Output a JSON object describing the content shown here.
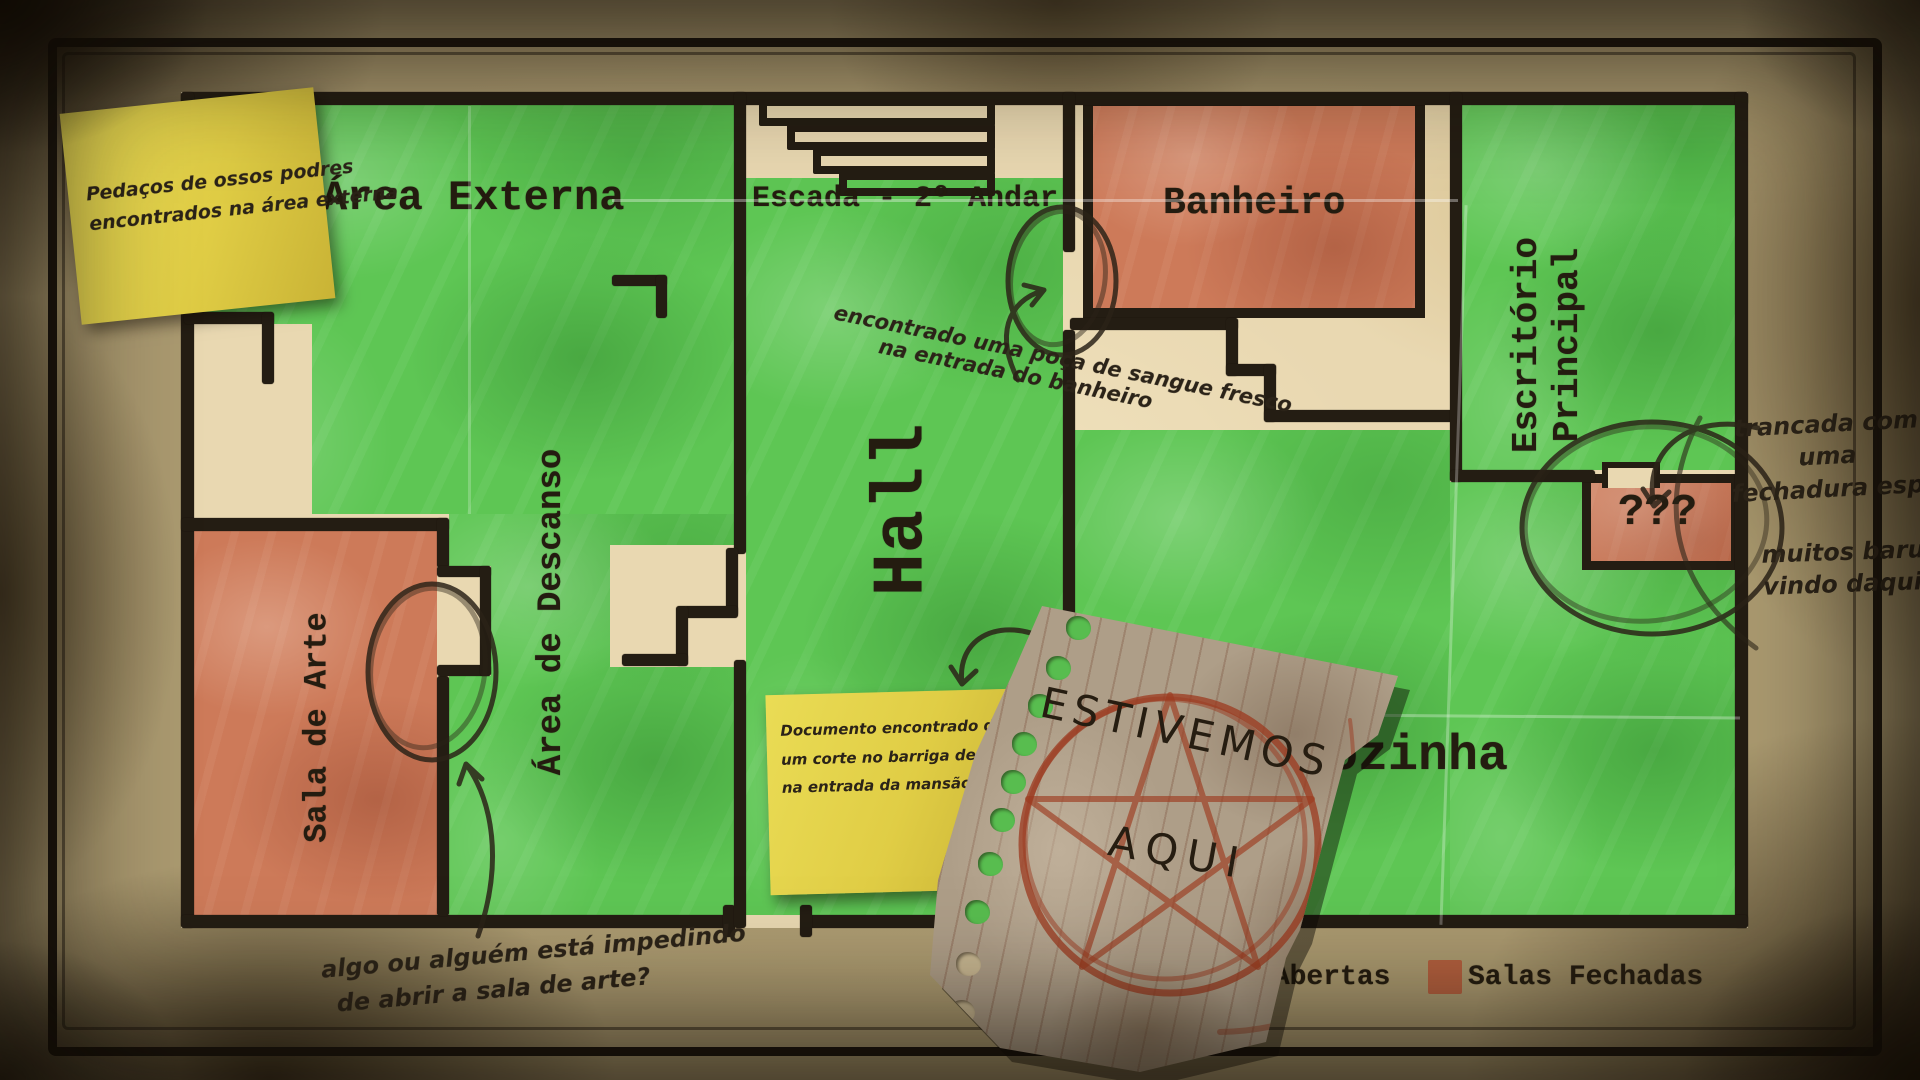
{
  "map": {
    "rooms": {
      "area_externa": "Área Externa",
      "escada": "Escada - 2º Andar",
      "banheiro": "Banheiro",
      "escritorio_l1": "Escritório",
      "escritorio_l2": "Principal",
      "hall": "Hall",
      "descanso": "Área de Descanso",
      "sala_arte": "Sala de Arte",
      "cozinha": "Cozinha",
      "unknown": "???"
    },
    "legend": {
      "open_label": "Salas Abertas",
      "closed_label": "Salas Fechadas",
      "open_color": "#5ec654",
      "closed_color": "#b4603f"
    }
  },
  "annotations": {
    "sticky_bones": {
      "l1": "Pedaços de ossos podres",
      "l2": "encontrados na área externa"
    },
    "sticky_document": {
      "l1": "Documento encontrado dentro de",
      "l2": "um corte no barriga de um corpo",
      "l3": "na entrada da mansão"
    },
    "blood": {
      "l1": "encontrado uma poça de sangue fresco",
      "l2": "na entrada do banheiro"
    },
    "locked": {
      "l1": "trancada com",
      "l2": "uma",
      "l3": "fechadura especial"
    },
    "noises": {
      "l1": "muitos barulhos",
      "l2": "vindo daqui"
    },
    "art_door": {
      "l1": "algo ou alguém está impedindo",
      "l2": "de abrir a sala de arte?"
    },
    "torn_note": {
      "l1": "ESTIVEMOS",
      "l2": "AQUI"
    }
  },
  "colors": {
    "ink": "#241d13",
    "open_room_green": "#5ec654",
    "closed_room_red": "#cd7a59",
    "sticky_yellow": "#e0cd45",
    "parchment": "#e9d8b1",
    "pentagram_red": "#9c3a1f"
  }
}
